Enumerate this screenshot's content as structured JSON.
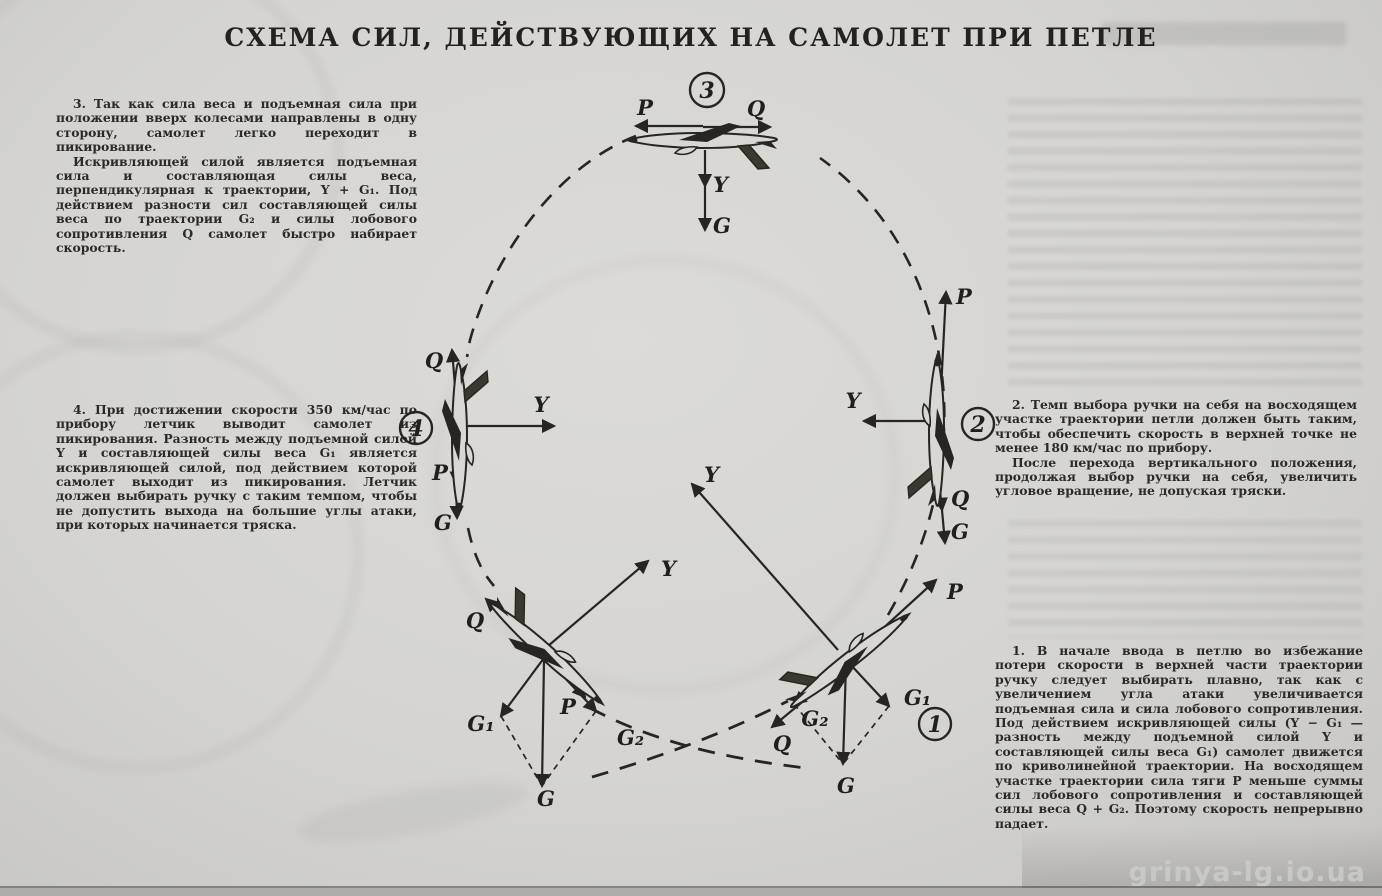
{
  "title": "СХЕМА СИЛ, ДЕЙСТВУЮЩИХ НА САМОЛЕТ ПРИ ПЕТЛЕ",
  "notes": {
    "note3": {
      "paragraphs": [
        "3. Так как сила веса и подъемная сила при положении вверх колесами направлены в одну сторону, самолет легко переходит в пикирование.",
        "Искривляющей силой является подъемная сила и составляющая силы веса, перпендикулярная к траектории, Y + G₁. Под действием разности сил составляющей силы веса по траектории G₂ и силы лобового сопротивления Q самолет быстро набирает скорость."
      ]
    },
    "note4": {
      "paragraphs": [
        "4. При достижении скорости 350 км/час по прибору летчик выводит самолет из пикирования. Разность между подъемной силой Y и составляющей силы веса G₁ является искривляющей силой, под действием которой самолет выходит из пикирования. Летчик должен выбирать ручку с таким темпом, чтобы не допустить выхода на большие углы атаки, при которых начинается тряска."
      ]
    },
    "note2": {
      "paragraphs": [
        "2. Темп выбора ручки на себя на восходящем участке траектории петли должен быть таким, чтобы обеспечить скорость в верхней точке не менее 180 км/час по прибору.",
        "После перехода вертикального положения, продолжая выбор ручки на себя, увеличить угловое вращение, не допуская тряски."
      ]
    },
    "note1": {
      "paragraphs": [
        "1. В начале ввода в петлю во избежание потери скорости в верхней части траектории ручку следует выбирать плавно, так как с увеличением угла атаки увеличивается подъемная сила и сила лобового сопротивления. Под действием искривляющей силы (Y − G₁ — разность между подъемной силой Y и составляющей силы веса G₁) самолет движется по криволинейной траектории. На восходящем участке траектории сила тяги P меньше суммы сил лобового сопротивления и составляющей силы веса Q + G₂. Поэтому скорость непрерывно падает."
      ]
    }
  },
  "diagram": {
    "top": {
      "badge": "3",
      "p": "P",
      "q": "Q",
      "y": "Y",
      "g": "G"
    },
    "right": {
      "badge": "2",
      "p": "P",
      "q": "Q",
      "y": "Y",
      "g": "G"
    },
    "left": {
      "badge": "4",
      "p": "P",
      "q": "Q",
      "y": "Y",
      "g": "G"
    },
    "bottom_left": {
      "p": "P",
      "q": "Q",
      "y": "Y",
      "g": "G",
      "g1": "G₁",
      "g2": "G₂"
    },
    "bottom_right": {
      "badge": "1",
      "p": "P",
      "q": "Q",
      "y": "Y",
      "g": "G",
      "g1": "G₁",
      "g2": "G₂"
    }
  },
  "watermark": "grinya-lg.io.ua"
}
